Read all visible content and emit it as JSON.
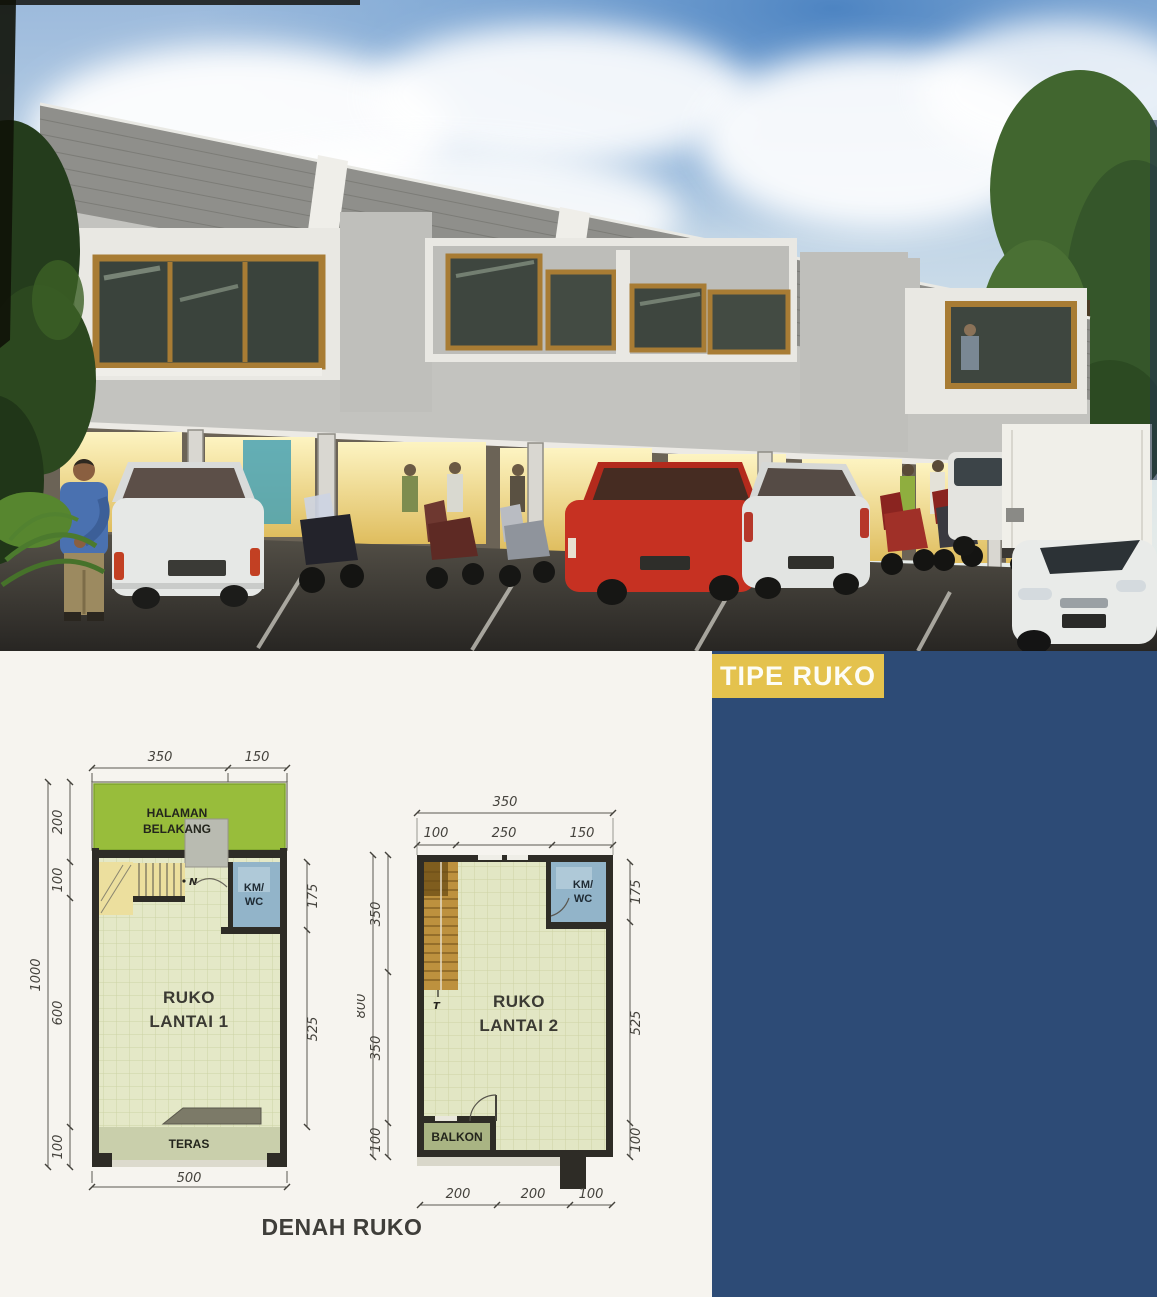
{
  "page": {
    "background": "#f6f4ef",
    "side_panel_color": "#2d4b76",
    "badge": {
      "label": "TIPE RUKO",
      "bg": "#e4c24d",
      "fg": "#fdfdf6"
    },
    "caption": "DENAH RUKO"
  },
  "photo": {
    "alt": "Two-storey modern ruko (shop-house) row at dusk with glowing shopfronts, parked cars, scooters and shoppers",
    "colors": {
      "sky": "#a8c4e0",
      "roof": "#8f8f8b",
      "wall": "#c3c3bf",
      "wood_frame": "#a87c34",
      "storefront_glow": "#f4e49c",
      "asphalt": "#33302b",
      "red_car": "#c63122"
    }
  },
  "plan1": {
    "title": [
      "RUKO",
      "LANTAI 1"
    ],
    "rooms": {
      "halaman": [
        "HALAMAN",
        "BELAKANG"
      ],
      "kmwc": [
        "KM/",
        "WC"
      ],
      "teras": "TERAS"
    },
    "marker_n": "N",
    "dims": {
      "top": [
        "350",
        "150"
      ],
      "left_outer": "1000",
      "left": [
        "200",
        "100",
        "600",
        "100"
      ],
      "right": [
        "175",
        "525"
      ],
      "bottom": "500"
    }
  },
  "plan2": {
    "title": [
      "RUKO",
      "LANTAI 2"
    ],
    "rooms": {
      "kmwc": [
        "KM/",
        "WC"
      ],
      "balkon": "BALKON"
    },
    "marker_t": "T",
    "dims": {
      "top_outer": "350",
      "top": [
        "100",
        "250",
        "150"
      ],
      "left_outer": "800",
      "left": [
        "350",
        "350",
        "100"
      ],
      "right": [
        "175",
        "525",
        "100"
      ],
      "bottom": [
        "200",
        "200",
        "100"
      ]
    }
  }
}
